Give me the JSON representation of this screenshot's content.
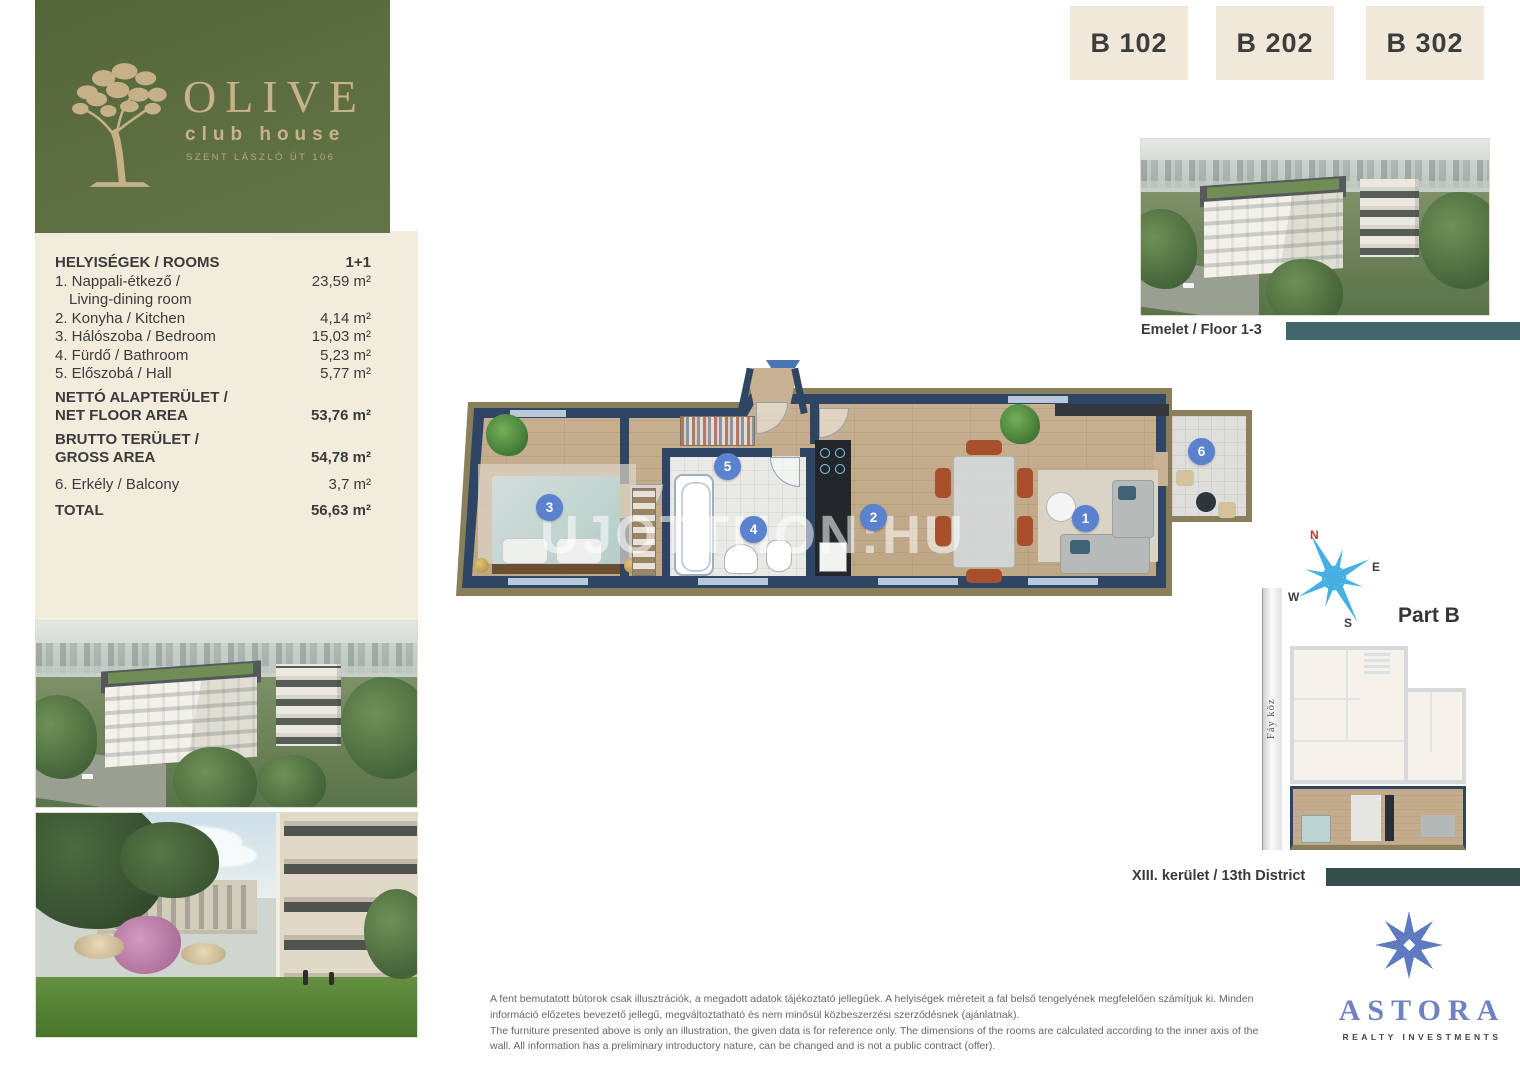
{
  "brand": {
    "name": "OLIVE",
    "subtitle": "club house",
    "address": "SZENT LÁSZLÓ ÚT 106",
    "logo_icon": "olive-tree"
  },
  "units": [
    {
      "label": "B 102"
    },
    {
      "label": "B 202"
    },
    {
      "label": "B 302"
    }
  ],
  "room_table": {
    "title": "HELYISÉGEK / ROOMS",
    "type": "1+1",
    "rows": [
      {
        "label": "1. Nappali-étkező /",
        "label2": "Living-dining room",
        "value": "23,59 m²"
      },
      {
        "label": "2. Konyha / Kitchen",
        "value": "4,14 m²"
      },
      {
        "label": "3. Hálószoba / Bedroom",
        "value": "15,03 m²"
      },
      {
        "label": "4. Fürdő / Bathroom",
        "value": "5,23 m²"
      },
      {
        "label": "5. Előszobá / Hall",
        "value": "5,77 m²"
      }
    ],
    "net": {
      "label": "NETTÓ ALAPTERÜLET /",
      "label2": "NET FLOOR AREA",
      "value": "53,76 m²"
    },
    "gross": {
      "label": "BRUTTO TERÜLET /",
      "label2": "GROSS AREA",
      "value": "54,78 m²"
    },
    "balcony": {
      "label": "6. Erkély / Balcony",
      "value": "3,7 m²"
    },
    "total": {
      "label": "TOTAL",
      "value": "56,63 m²"
    }
  },
  "captions": {
    "floor": "Emelet / Floor 1-3",
    "district": "XIII. kerület / 13th District",
    "part": "Part B",
    "street": "Fáy köz"
  },
  "compass": {
    "north": "N",
    "east": "E",
    "south": "S",
    "west": "W"
  },
  "floorplan": {
    "watermark": "UJOTTHON:HU",
    "room_labels": [
      "1",
      "2",
      "3",
      "4",
      "5",
      "6"
    ]
  },
  "disclaimer": {
    "hu": "A fent bemutatott bútorok csak illusztrációk, a megadott adatok tájékoztató jellegűek. A helyiségek méreteit a fal belső tengelyének megfelelően számítjuk ki. Minden információ előzetes bevezető jellegű, megváltoztatható és nem minősül közbeszerzési szerződésnek (ajánlatnak).",
    "en": "The furniture presented above is only an illustration, the given data is for reference only. The dimensions of the rooms are calculated according to the inner axis of the wall. All information has a preliminary introductory nature, can be changed and is not a public contract (offer)."
  },
  "developer": {
    "name": "ASTORA",
    "tagline": "REALTY INVESTMENTS"
  },
  "colors": {
    "brand_green": "#5d6e41",
    "brand_tan": "#c8b28a",
    "cream": "#f2ecdd",
    "badge_bg": "#f0e9da",
    "badge_text": "#3d3d3d",
    "teal_bar": "#41666b",
    "teal_bar_dark": "#344f4a",
    "wall_navy": "#2e4564",
    "floor_wood": "#c3ac8c",
    "room_badge_blue": "#5b82ce",
    "compass_blue": "#45b0e2",
    "north_red": "#c0392b",
    "astora_blue": "#6f83c2"
  }
}
